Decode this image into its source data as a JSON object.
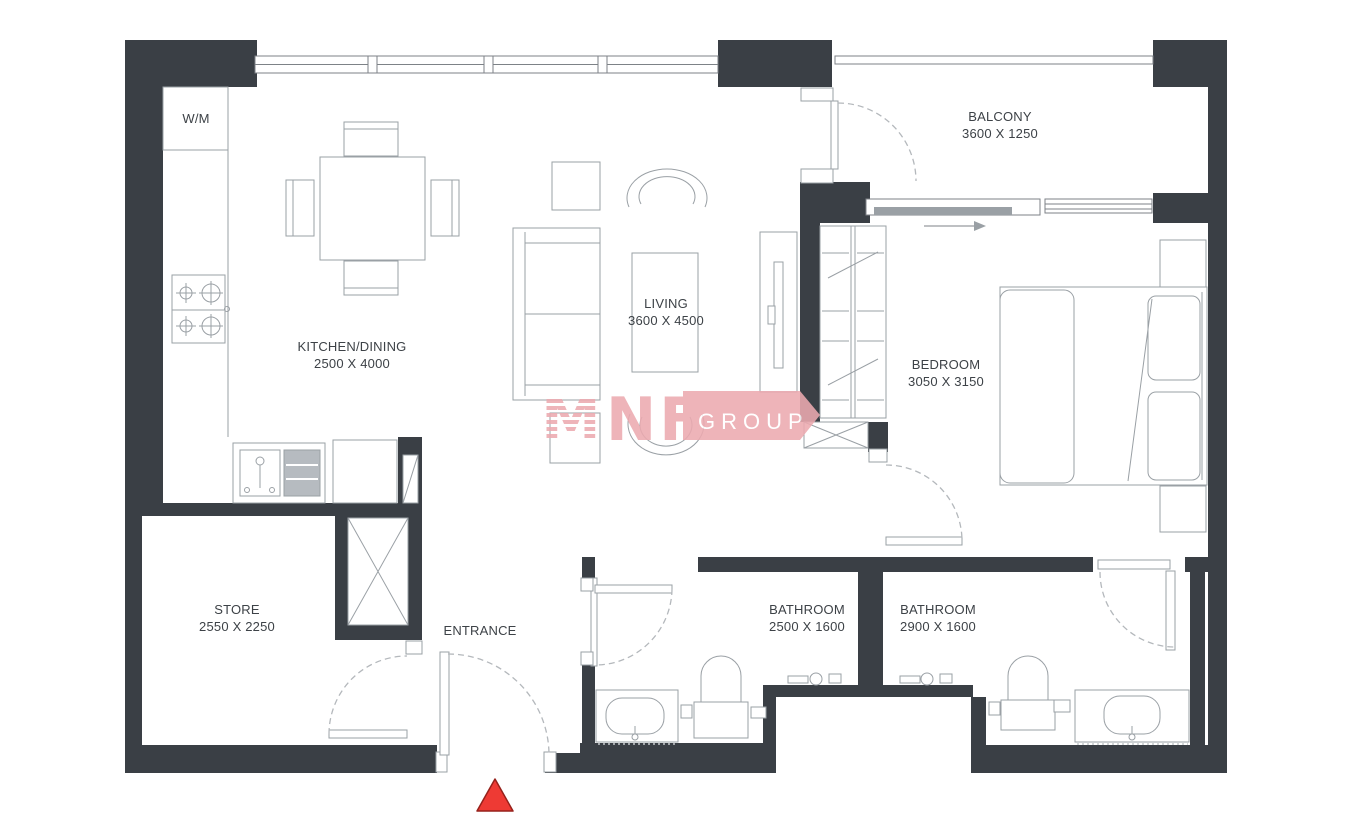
{
  "rooms": {
    "kitchen": {
      "name": "KITCHEN/DINING",
      "dims": "2500 X 4000"
    },
    "living": {
      "name": "LIVING",
      "dims": "3600 X 4500"
    },
    "balcony": {
      "name": "BALCONY",
      "dims": "3600 X 1250"
    },
    "bedroom": {
      "name": "BEDROOM",
      "dims": "3050 X 3150"
    },
    "store": {
      "name": "STORE",
      "dims": "2550 X 2250"
    },
    "bathroom1": {
      "name": "BATHROOM",
      "dims": "2500 X 1600"
    },
    "bathroom2": {
      "name": "BATHROOM",
      "dims": "2900 X 1600"
    },
    "entrance": {
      "name": "ENTRANCE"
    },
    "wm": {
      "label": "W/M"
    }
  },
  "logo": {
    "m": "M",
    "nf": "NF",
    "group": "GROUP"
  },
  "markers": {
    "entrance_arrow": "red-triangle"
  },
  "colors": {
    "wall": "#3a3f45",
    "line": "#9aa0a5",
    "line_dark": "#7d8287",
    "dash": "#b4b8bc",
    "pink": "#ecaab0",
    "red": "#ee3a34",
    "text": "#3d4247",
    "drain": "#b6bbc0"
  }
}
